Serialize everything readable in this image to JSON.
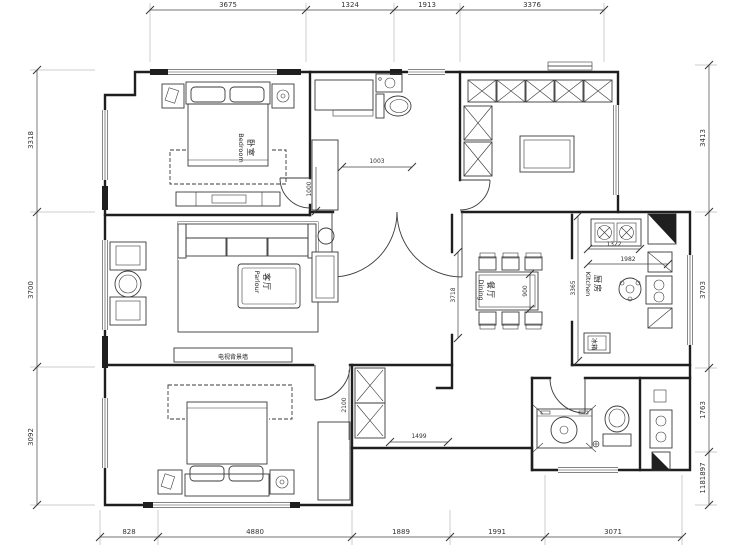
{
  "plan": {
    "dims": {
      "top": [
        "3675",
        "1324",
        "1913",
        "3376"
      ],
      "bottom": [
        "828",
        "4880",
        "1889",
        "1991",
        "3071"
      ],
      "left": [
        "3318",
        "3700",
        "3092"
      ],
      "right": [
        "3413",
        "3703",
        "1763",
        "1181897"
      ],
      "foyer_w": "1003",
      "foyer_h": "1000",
      "hall_w": "1499",
      "hall_h": "2100",
      "dining_h": "3718",
      "table_w": "900",
      "kitchen_h": "3365",
      "kitchen_w1": "1322",
      "kitchen_w2": "1982"
    },
    "rooms": {
      "bedroom_top": {
        "zh": "卧室",
        "en": "Bedroom"
      },
      "living": {
        "zh": "客厅",
        "en": "Parlour"
      },
      "dining": {
        "zh": "餐厅",
        "en": "Dining"
      },
      "kitchen": {
        "zh": "厨房",
        "en": "Kitchen"
      },
      "fridge": {
        "zh": "冰箱"
      },
      "tv_wall": {
        "zh": "电视背景墙"
      }
    },
    "colors": {
      "line": "#1f1f1f",
      "bg": "#ffffff"
    }
  }
}
